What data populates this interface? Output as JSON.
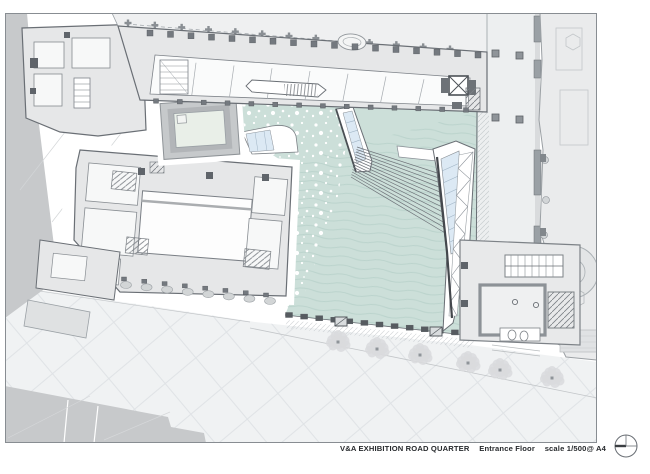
{
  "title_block": {
    "project": "V&A EXHIBITION ROAD QUARTER",
    "drawing": "Entrance Floor",
    "scale": "scale 1/500@ A4"
  },
  "icons": {
    "north_symbol": "north-orientation-icon"
  },
  "colors": {
    "plaza": "#ccdfd9",
    "wave": "#b9d2cb",
    "skylight": "#dce9f4",
    "building": "#e6e7e8",
    "wall": "#686d73",
    "street": "#edeff0",
    "pavement": "#f0f2f3",
    "wedge": "#c7c9cb",
    "tree": "#d9dbdd",
    "pool": "#e9efe8",
    "right_building": "#eaebec",
    "dark_pier": "#565b60"
  }
}
